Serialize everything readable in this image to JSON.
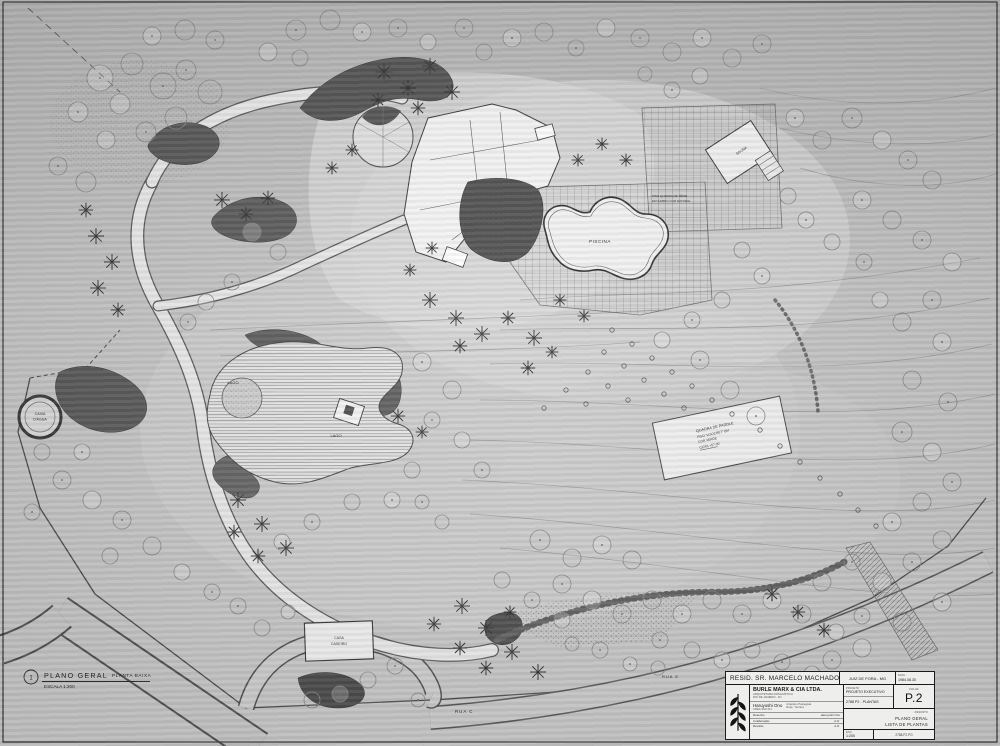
{
  "colors": {
    "paper": "#c2c2c2",
    "ink": "#3c3c3c",
    "dark_mass": "#4f4f4f",
    "white_structure": "#f3f3f1",
    "water_line": "#6a6a6a"
  },
  "drawing_label": {
    "number": "1",
    "title": "PLANO GERAL",
    "scale": "ESCALA 1:200",
    "subtitle": "PLANTA BAIXA"
  },
  "plan_labels": {
    "piscina": "PISCINA",
    "lago": "LAGO",
    "caixa_dagua_1": "CAIXA",
    "caixa_dagua_2": "D'ÁGUA",
    "quadra_1": "QUADRA DE PADDLE",
    "quadra_2": "PISO \"LISOCRET\" EM",
    "quadra_3": "COR VERDE",
    "quadra_4": "COTA +57.00",
    "tenis_1": "PISO QUADRA DE TÊNIS",
    "tenis_2": "EM SAIBRO COR NATURAL",
    "sauna": "SAUNA",
    "casa_1": "CASA",
    "casa_2": "CASEIRO",
    "rua_c": "RUA C",
    "rua_e": "RUA E"
  },
  "title_block": {
    "project": "RESID. SR. MARCELO MACHADO",
    "location": "JUIZ DE FORA - MG",
    "date_label": "DATA",
    "date": "1984.08.30",
    "firm": "BURLE MARX & CIA LTDA.",
    "firm_line1": "ARQUITETURA PAISAGÍSTICA",
    "firm_line2": "RIO DE JANEIRO - RJ",
    "architect": "Haruyoshi Ono",
    "architect_reg": "CREA 30-D RJ",
    "architect_title1": "Arquiteto Paisagista",
    "architect_title2": "Resp. Técnico",
    "row1_label": "Desenho",
    "row1_value": "Haruyoshi Ono",
    "row2_label": "Colaboração",
    "row2_value": "A.O.",
    "row3_label": "Revisão",
    "row3_value": "A.O.",
    "phase_label": "PROJETO",
    "phase": "PROJETO EXECUTIVO",
    "job_no": "2788 P2 - PLANTAS",
    "sheet_label": "FOLHA",
    "sheet_no": "P.2",
    "content_label": "ASSUNTO",
    "content_1": "PLANO GERAL",
    "content_2": "LISTA DE PLANTAS",
    "bottom_scale_label": "ESC.",
    "bottom_scale": "1:200",
    "bottom_code": "2788.P2.PG"
  }
}
